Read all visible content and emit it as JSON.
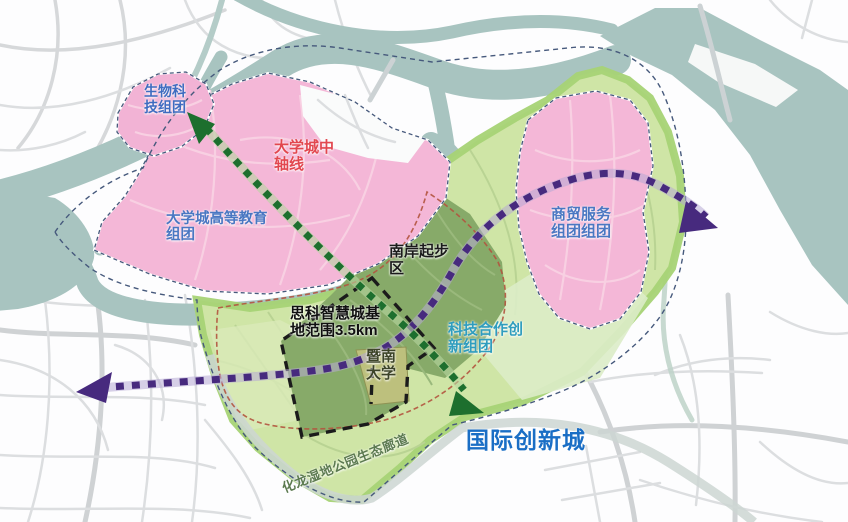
{
  "map": {
    "labels": {
      "bio_tech_cluster": {
        "lines": [
          "生物科",
          "技组团"
        ],
        "color": "#3f6cc0"
      },
      "central_axis": {
        "lines": [
          "大学城中",
          "轴线"
        ],
        "color": "#e2474f"
      },
      "higher_education_cluster": {
        "lines": [
          "大学城高等教育",
          "组团"
        ],
        "color": "#4a77c2"
      },
      "south_bank_startup_area": {
        "lines": [
          "南岸起步",
          "区"
        ],
        "color": "#1b1b1b"
      },
      "cisco_smart_city_base": {
        "lines": [
          "思科智慧城基",
          "地范围3.5km"
        ],
        "color": "#101010"
      },
      "jinan_university": {
        "lines": [
          "暨南",
          "大学"
        ],
        "color": "#3d4429"
      },
      "tech_cooperation_cluster": {
        "lines": [
          "科技合作创",
          "新组团"
        ],
        "color": "#2f9dbe"
      },
      "trade_service_cluster": {
        "lines": [
          "商贸服务",
          "组团组团"
        ],
        "color": "#4a77c2"
      },
      "international_innovation_city": {
        "text": "国际创新城",
        "color": "#1a6ec5"
      },
      "hualong_wetland_corridor": {
        "text": "化龙湿地公园生态廊道",
        "color": "#5c7a50"
      }
    },
    "colors": {
      "pink_region": "#f4b7d7",
      "pink_region_small": "#f2b3d5",
      "light_green_region": "#cfe5a6",
      "green_border_band": "#a6d375",
      "dark_green_region": "#87aa69",
      "campus_block": "#bdc07d",
      "river": "#a8c4c0",
      "purple_arrow": "#472a7e",
      "green_arrow": "#1d6f2e",
      "black_dashed_boundary": "#1b1b1b",
      "red_dashed_boundary": "#b2543f",
      "navy_dashed_boundary": "#46597c"
    }
  }
}
